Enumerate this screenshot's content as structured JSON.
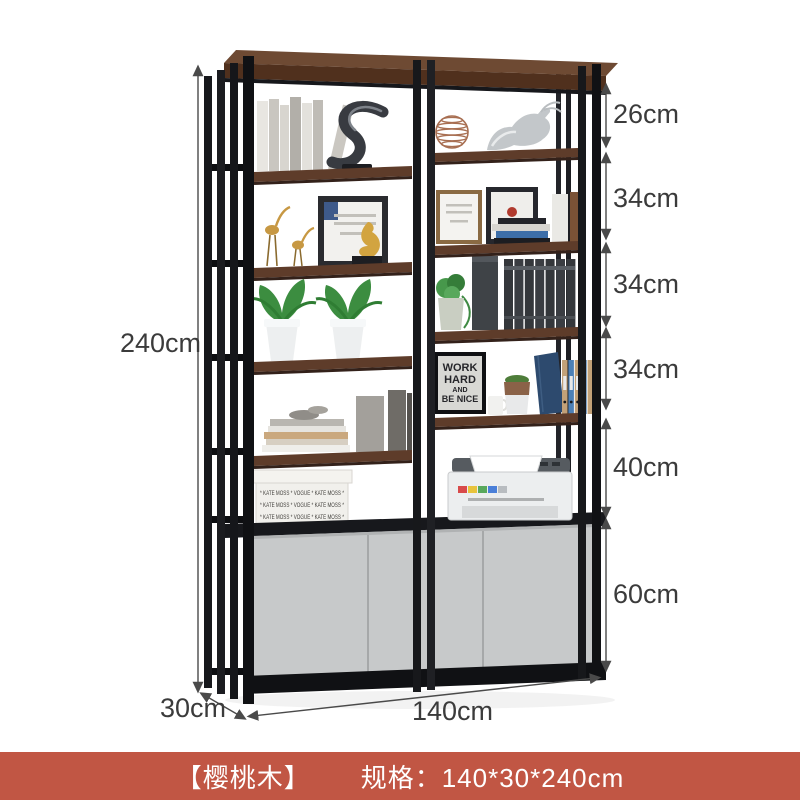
{
  "product": {
    "dimension_labels": {
      "height_total": "240cm",
      "depth": "30cm",
      "width": "140cm",
      "sections": [
        {
          "label": "26cm"
        },
        {
          "label": "34cm"
        },
        {
          "label": "34cm"
        },
        {
          "label": "34cm"
        },
        {
          "label": "40cm"
        },
        {
          "label": "60cm"
        }
      ]
    },
    "illustration_text": {
      "poster_lines": [
        "WORK",
        "HARD",
        "AND",
        "BE NICE"
      ],
      "box_pattern": "* KATE MOSS * VOGUE * KATE MOSS *"
    },
    "colors": {
      "caption_bar": "#c15644",
      "frame": "#1b1c20",
      "wood": "#5e3c2a",
      "cabinet": "#c7c9ca",
      "arrow": "#4a4a4a"
    }
  },
  "caption": {
    "material": "【樱桃木】",
    "spec": "规格：140*30*240cm"
  }
}
